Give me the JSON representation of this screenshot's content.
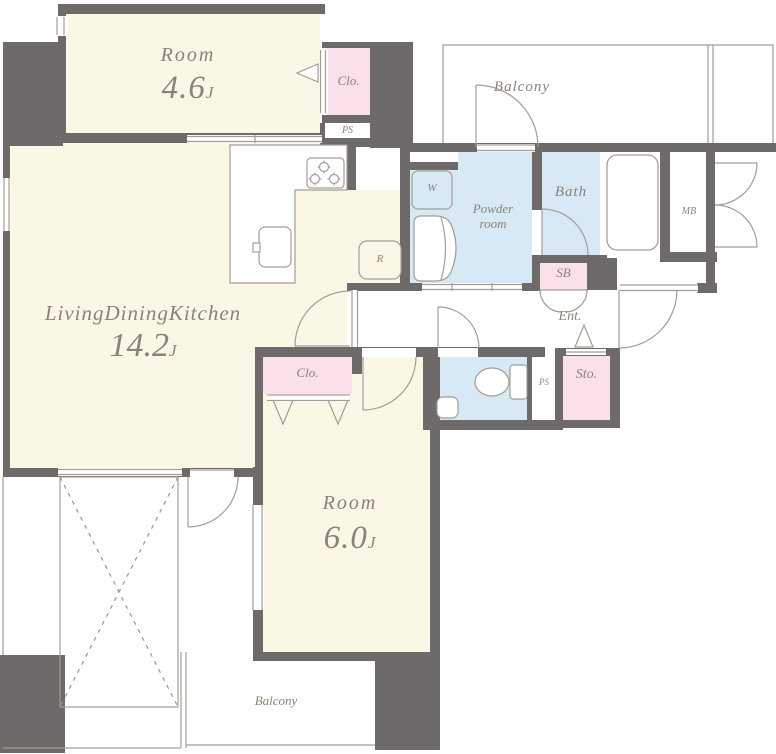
{
  "plan": {
    "type": "apartment-floor-plan",
    "colors": {
      "wall": "#6e6a6a",
      "room_fill": "#fbf7e5",
      "closet_fill": "#f9e0ea",
      "wet_area_fill": "#d7e9f4",
      "thin_line": "#a39d96",
      "text": "#8b8379"
    },
    "rooms": {
      "bedroom1": {
        "name": "Room",
        "area": "4.6",
        "unit": "J"
      },
      "ldk": {
        "name": "LivingDiningKitchen",
        "area": "14.2",
        "unit": "J"
      },
      "bedroom2": {
        "name": "Room",
        "area": "6.0",
        "unit": "J"
      },
      "balcony_top": {
        "label": "Balcony"
      },
      "balcony_bottom": {
        "label": "Balcony"
      },
      "powder_room": {
        "label": "Powder room"
      },
      "bath": {
        "label": "Bath"
      },
      "closet_top": {
        "label": "Clo."
      },
      "closet_middle": {
        "label": "Clo."
      },
      "storage": {
        "label": "Sto."
      },
      "shoe_box": {
        "label": "SB"
      },
      "entrance": {
        "label": "Ent."
      },
      "meter_box": {
        "label": "MB"
      },
      "pipe_shaft_top": {
        "label": "PS"
      },
      "pipe_shaft_lower": {
        "label": "PS"
      },
      "washer_space": {
        "label": "W"
      },
      "refrigerator_space": {
        "label": "R"
      }
    }
  }
}
